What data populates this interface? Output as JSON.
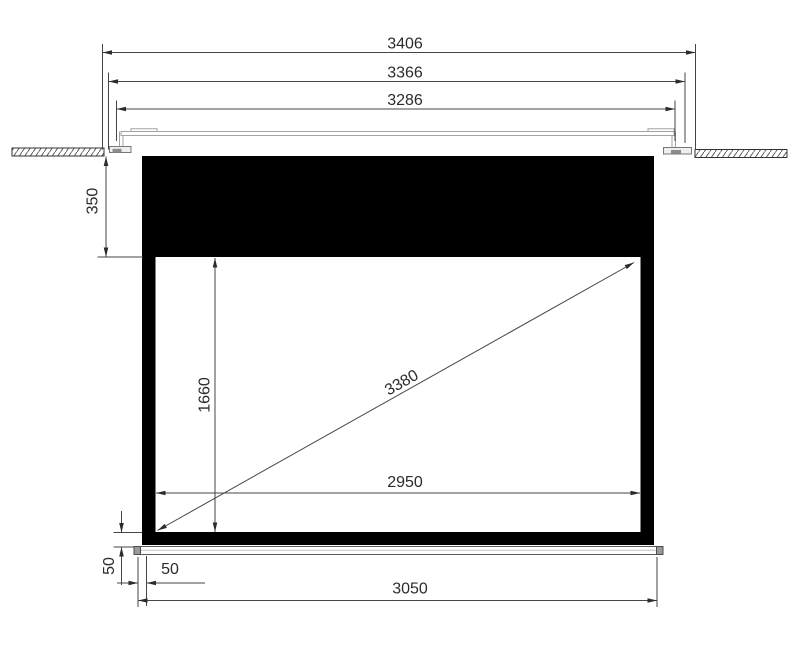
{
  "diagram": {
    "dimensions": {
      "overall_width": "3406",
      "flange_width": "3366",
      "inner_width": "3286",
      "top_drop": "350",
      "viewing_height": "1660",
      "diagonal": "3380",
      "viewing_width": "2950",
      "bar_offset_vertical": "50",
      "bar_offset_horizontal": "50",
      "bar_width": "3050"
    }
  },
  "colors": {
    "background": "#ffffff",
    "dimension_line": "#454545",
    "text": "#2b2b2b",
    "screen_black": "#000000",
    "casing_gray": "#a3a3a3",
    "foot_fill": "#efefef",
    "foot_dark": "#8c8c8c",
    "hatch": "#4a4a4a",
    "ceiling_outline": "#333333",
    "bar_outline": "#5a5a5a",
    "bar_cap": "#9a9a9a",
    "bar_fill": "#ffffff"
  }
}
